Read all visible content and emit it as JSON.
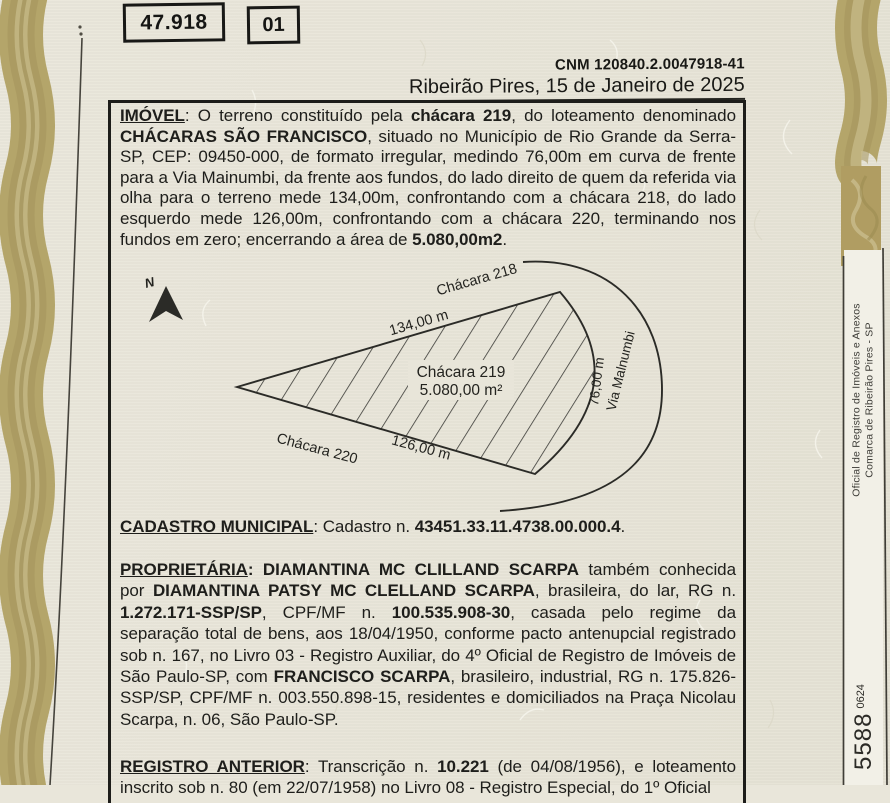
{
  "header": {
    "matricula_number": "47.918",
    "page_number": "01",
    "cnm": "CNM 120840.2.0047918-41",
    "date_line": "Ribeirão Pires, 15 de Janeiro de 2025"
  },
  "imovel": {
    "runs": [
      {
        "t": "IMÓVEL",
        "b": true,
        "u": true
      },
      {
        "t": ": O terreno constituído pela "
      },
      {
        "t": "chácara 219",
        "b": true
      },
      {
        "t": ", do loteamento denominado "
      },
      {
        "t": "CHÁCARAS SÃO FRANCISCO",
        "b": true
      },
      {
        "t": ", situado no Município de Rio Grande da Serra-SP, CEP: 09450-000, de formato irregular, medindo 76,00m em curva de frente para a Via Mainumbi, da frente aos fundos, do lado direito de quem da referida via olha para o terreno mede 134,00m, confrontando com a chácara 218, do lado esquerdo mede 126,00m, confrontando com a chácara 220, terminando nos fundos em zero; encerrando a área de "
      },
      {
        "t": "5.080,00m2",
        "b": true
      },
      {
        "t": "."
      }
    ]
  },
  "cadastro": {
    "runs": [
      {
        "t": "CADASTRO MUNICIPAL",
        "b": true,
        "u": true
      },
      {
        "t": ": Cadastro n. "
      },
      {
        "t": "43451.33.11.4738.00.000.4",
        "b": true
      },
      {
        "t": "."
      }
    ]
  },
  "proprietaria": {
    "runs": [
      {
        "t": "PROPRIETÁRIA",
        "b": true,
        "u": true
      },
      {
        "t": ": ",
        "b": true
      },
      {
        "t": "DIAMANTINA MC CLILLAND SCARPA",
        "b": true
      },
      {
        "t": " também conhecida por "
      },
      {
        "t": "DIAMANTINA PATSY MC CLELLAND SCARPA",
        "b": true
      },
      {
        "t": ", brasileira, do lar, RG n. "
      },
      {
        "t": "1.272.171-SSP/SP",
        "b": true
      },
      {
        "t": ", CPF/MF n. "
      },
      {
        "t": "100.535.908-30",
        "b": true
      },
      {
        "t": ", casada pelo regime da separação total de bens, aos 18/04/1950, conforme pacto antenupcial registrado sob n. 167, no Livro 03 - Registro Auxiliar, do 4º Oficial de Registro de Imóveis de São Paulo-SP, com "
      },
      {
        "t": "FRANCISCO SCARPA",
        "b": true
      },
      {
        "t": ", brasileiro, industrial, RG n. 175.826-SSP/SP, CPF/MF n. 003.550.898-15, residentes e domiciliados na Praça Nicolau Scarpa, n. 06, São Paulo-SP."
      }
    ]
  },
  "registro_anterior": {
    "runs": [
      {
        "t": "REGISTRO ANTERIOR",
        "b": true,
        "u": true
      },
      {
        "t": ": Transcrição n. "
      },
      {
        "t": "10.221",
        "b": true
      },
      {
        "t": " (de 04/08/1956), e loteamento inscrito sob n. 80 (em 22/07/1958) no Livro 08 - Registro Especial, do 1º Oficial"
      }
    ]
  },
  "diagram": {
    "north_label": "N",
    "top_neighbor": "Chácara 218",
    "top_length": "134,00 m",
    "parcel_name": "Chácara 219",
    "parcel_area": "5.080,00 m²",
    "bottom_length": "126,00 m",
    "bottom_neighbor": "Chácara 220",
    "front_length": "76,00 m",
    "road_name": "Via Malnumbi"
  },
  "sidebar": {
    "office_line1": "Oficial de Registro de Imóveis e Anexos",
    "office_line2": "Comarca de Ribeirão Pires - SP",
    "code_large": "5588",
    "code_small": "0624"
  },
  "colors": {
    "paper": "#e9e6da",
    "ink": "#1d1d1a",
    "border_tan": "#b4a56a",
    "strip_bg": "#f2f0e7"
  }
}
